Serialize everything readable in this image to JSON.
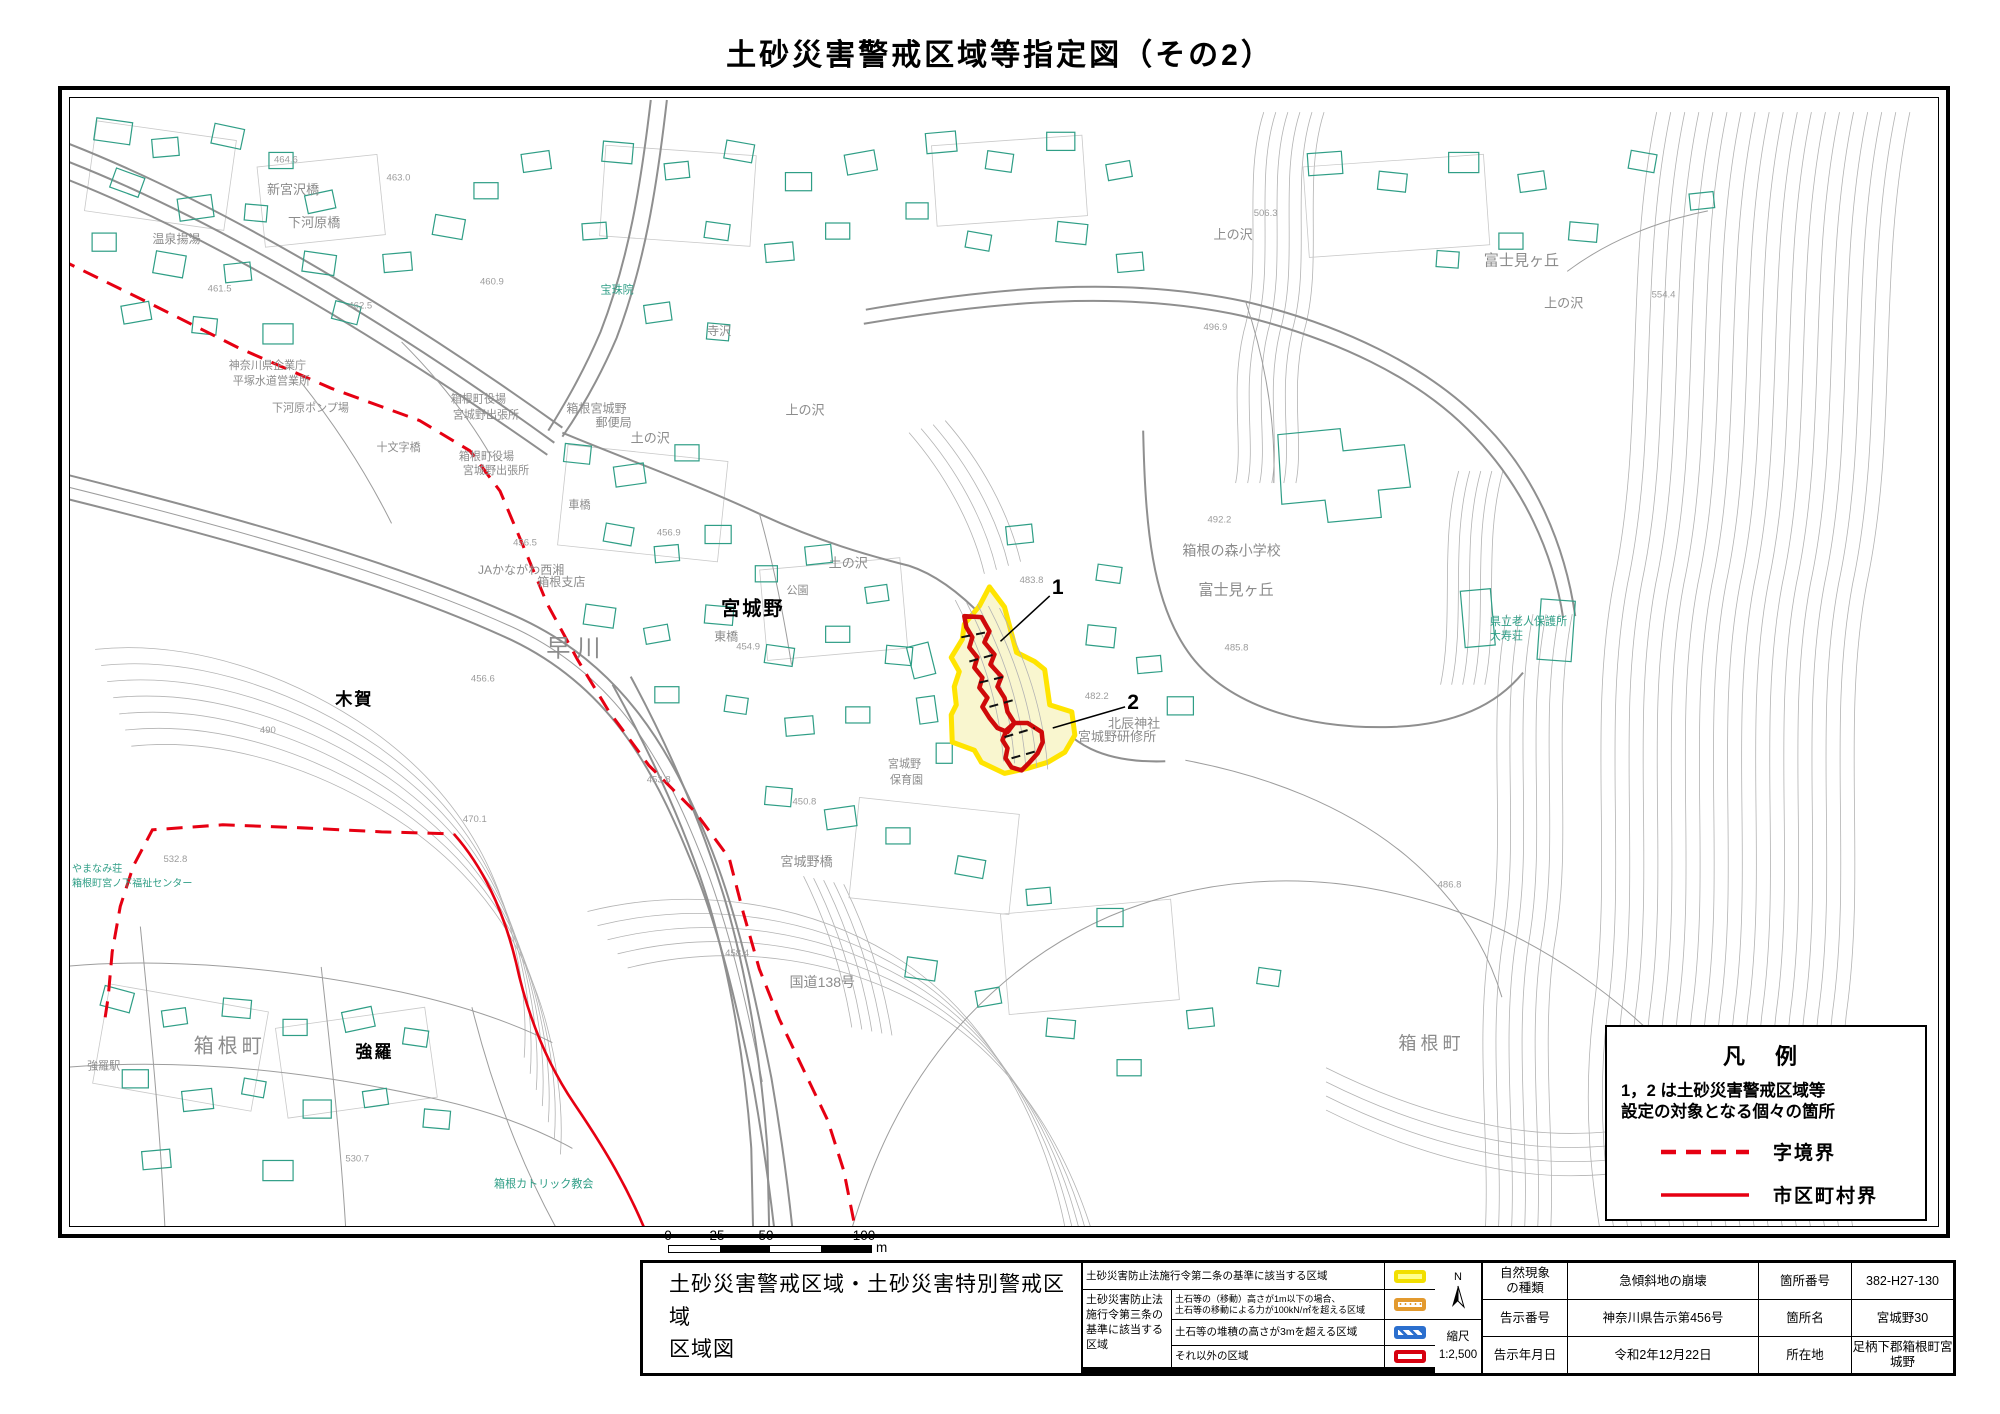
{
  "title": "土砂災害警戒区域等指定図（その2）",
  "legend_box": {
    "title": "凡 例",
    "desc_line1": "1，2 は土砂災害警戒区域等",
    "desc_line2": "設定の対象となる個々の箇所",
    "dashed_label": "字境界",
    "solid_label": "市区町村界"
  },
  "scale_bar": {
    "n0": "0",
    "n25": "25",
    "n50": "50",
    "n100": "100",
    "unit": "m"
  },
  "footer": {
    "map_title_line1": "土砂災害警戒区域・土砂災害特別警戒区域",
    "map_title_line2": "区域図",
    "legend": {
      "row1": "土砂災害防止法施行令第二条の基準に該当する区域",
      "group_label": "土砂災害防止法施行令第三条の基準に該当する区域",
      "row2_line1": "土石等の（移動）高さが1m以下の場合、",
      "row2_line2": "土石等の移動による力が100kN/㎡を超える区域",
      "row3": "土石等の堆積の高さが3mを超える区域",
      "row4": "それ以外の区域"
    },
    "compass_n": "N",
    "scale_label": "縮尺",
    "scale_value": "1:2,500",
    "fields": [
      {
        "l1": "自然現象",
        "l1b": "の種類",
        "v1": "急傾斜地の崩壊",
        "l2": "箇所番号",
        "v2": "382-H27-130"
      },
      {
        "l1": "告示番号",
        "l1b": "",
        "v1": "神奈川県告示第456号",
        "l2": "箇所名",
        "v2": "宮城野30"
      },
      {
        "l1": "告示年月日",
        "l1b": "",
        "v1": "令和2年12月22日",
        "l2": "所在地",
        "v2": "足柄下郡箱根町宮城野"
      }
    ]
  },
  "map": {
    "zone1": "1",
    "zone2": "2",
    "labels": [
      "新宮沢橋",
      "下河原橋",
      "温泉揚湯",
      "神奈川県企業庁",
      "平塚水道営業所",
      "下河原ポンプ場",
      "箱根町役場",
      "宮城野出張所",
      "十文字橋",
      "箱根町役場",
      "宮城野出張所",
      "箱根宮城野",
      "郵便局",
      "JAかながわ西湘",
      "箱根支店",
      "早川",
      "宮城野",
      "東橋",
      "公園",
      "土の沢",
      "土の沢",
      "上の沢",
      "寺沢",
      "宝珠院",
      "車橋",
      "木賀",
      "箱根町",
      "強羅",
      "強羅駅",
      "箱根カトリック教会",
      "やまなみ荘",
      "箱根町宮ノ下福祉センター",
      "箱根の森小学校",
      "富士見ヶ丘",
      "北辰神社",
      "宮城野研修所",
      "宮城野",
      "保育園",
      "県立老人保護所",
      "大寿荘",
      "富士見ヶ丘",
      "上の沢",
      "上の沢",
      "宮城野橋",
      "国道138号",
      "箱根町"
    ],
    "elevations": [
      "464.6",
      "463.0",
      "460.9",
      "461.5",
      "462.5",
      "456.9",
      "456.5",
      "454.9",
      "453.8",
      "450.8",
      "458.4",
      "490",
      "532.8",
      "470.1",
      "530.7",
      "483.8",
      "482.2",
      "492.2",
      "485.8",
      "506.3",
      "496.9",
      "554.4",
      "456.6",
      "486.8"
    ]
  }
}
